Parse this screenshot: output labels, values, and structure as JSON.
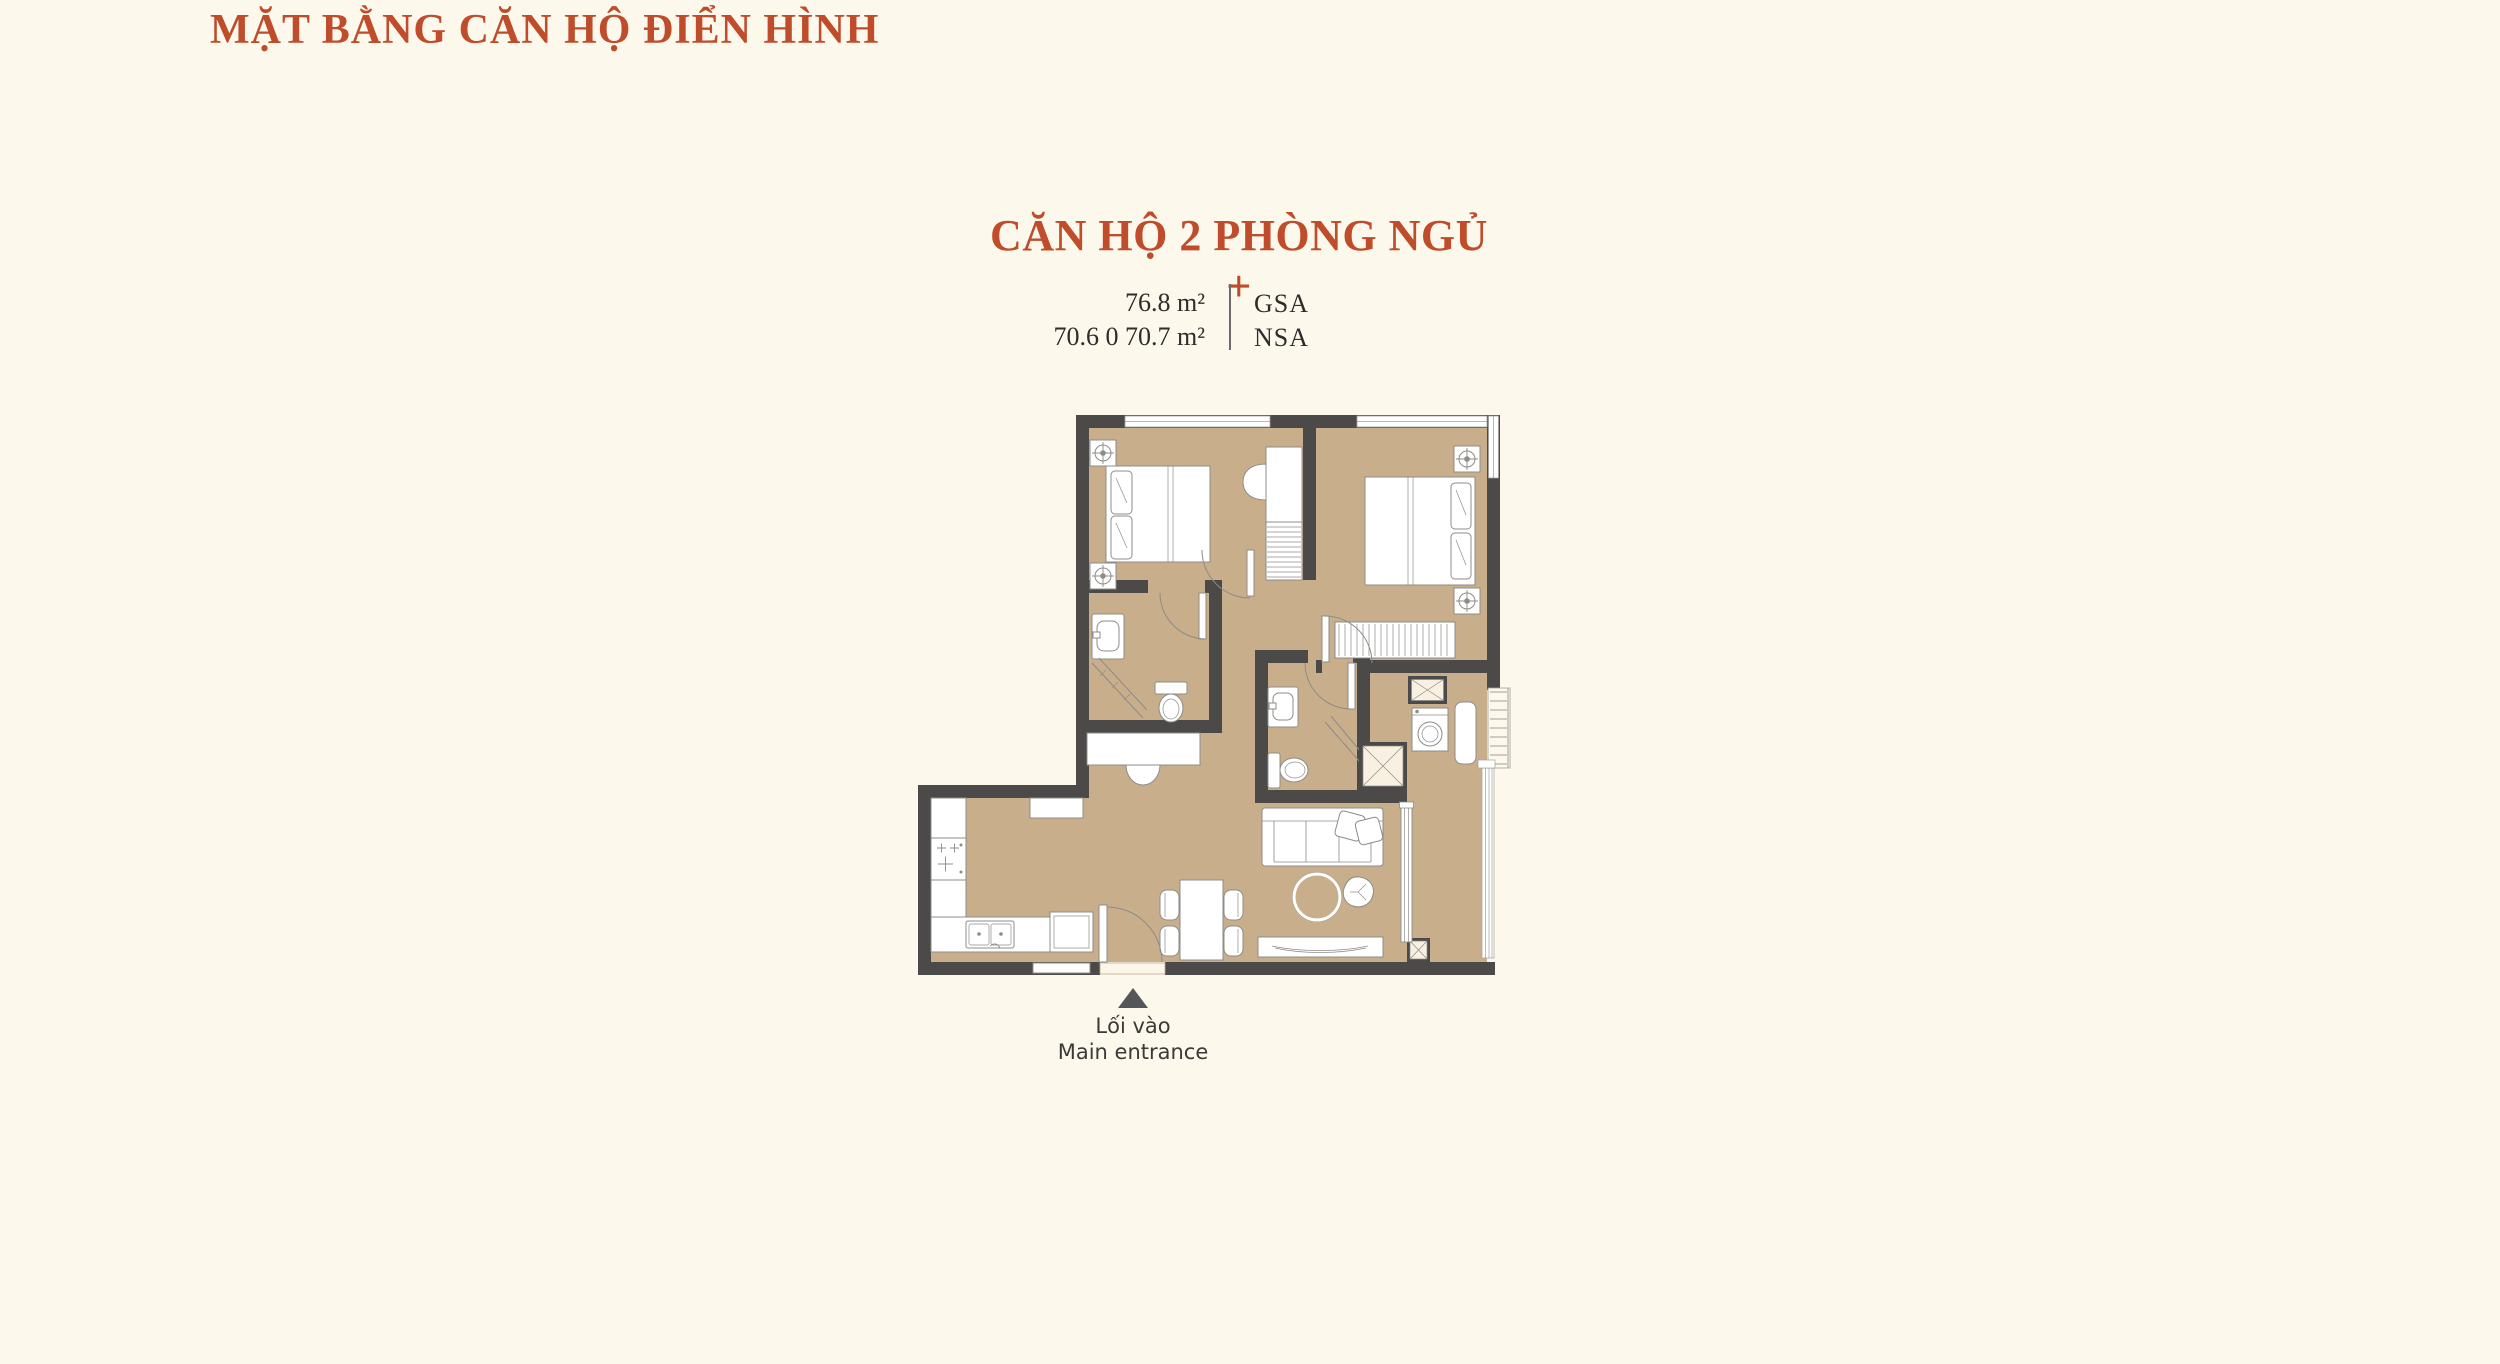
{
  "header": {
    "title": "MẶT BẰNG CĂN HỘ ĐIỂN HÌNH"
  },
  "unit": {
    "name": "CĂN HỘ 2 PHÒNG NGỦ +",
    "areas": [
      {
        "value": "76.8 m²",
        "label": "GSA"
      },
      {
        "value": "70.6 0 70.7 m²",
        "label": "NSA"
      }
    ]
  },
  "entrance": {
    "label_vi": "Lối vào",
    "label_en": "Main entrance"
  },
  "colors": {
    "background": "#fdf8ec",
    "accent_orange": "#bf4c2b",
    "wall": "#4b4a48",
    "floor": "#c9ae8b",
    "furniture_line": "#8d8c88",
    "text_dark": "#2e2d2b",
    "entrance_marker": "#55565a"
  }
}
